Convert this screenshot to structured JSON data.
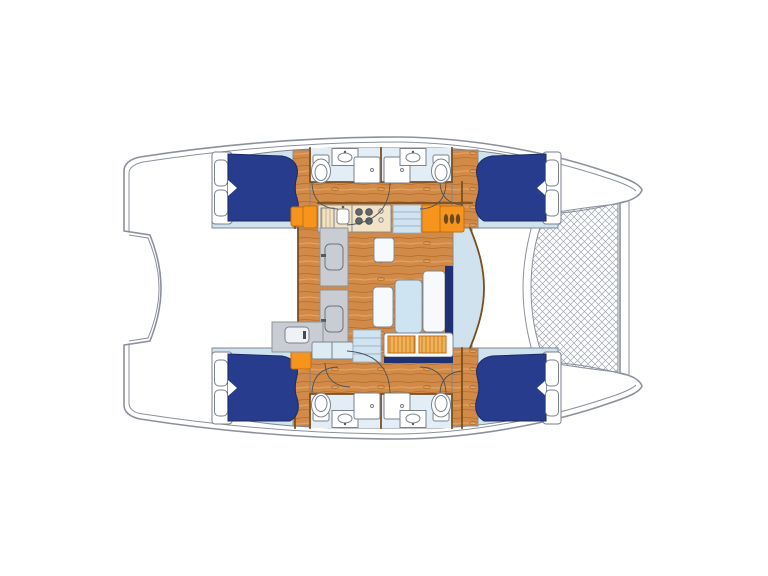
{
  "figure": {
    "kind": "catamaran-floor-plan",
    "view": "top-down deck plan, bow to the right, stern to the left",
    "cabins": 4,
    "bathrooms": 4,
    "berths": "4 double beds with navy duvets and white pillows",
    "features": [
      "bow trampoline net",
      "central saloon with table and settee",
      "galley with 4-burner stove and sink",
      "steps down to each hull",
      "wet bar",
      "companionway doors"
    ]
  },
  "colors": {
    "deck": "#ffffff",
    "outline": "#8b919b",
    "cabin": "#cfe2ee",
    "bath": "#e3edf5",
    "wood": "#d28a49",
    "woodDark": "#b4702c",
    "woodLight": "#e7ab6a",
    "wall": "#7c4e1d",
    "bed": "#283c8e",
    "bedStroke": "#1b2a66",
    "orange": "#f7941e",
    "orangeStroke": "#c06f10",
    "orangeHatch": "#f2b25c",
    "gray": "#c9cdd3",
    "grayStroke": "#8d929b",
    "cushion": "#cfe4f2",
    "seatWhite": "#f7fafc",
    "navyTrim": "#203173",
    "step": "#cfe3f0",
    "counter": "#f2e3c6",
    "fixture": "#7a828c",
    "net": "#a0a7b0",
    "arc": "#4d525a",
    "burner": "#61656c",
    "white": "#ffffff"
  }
}
